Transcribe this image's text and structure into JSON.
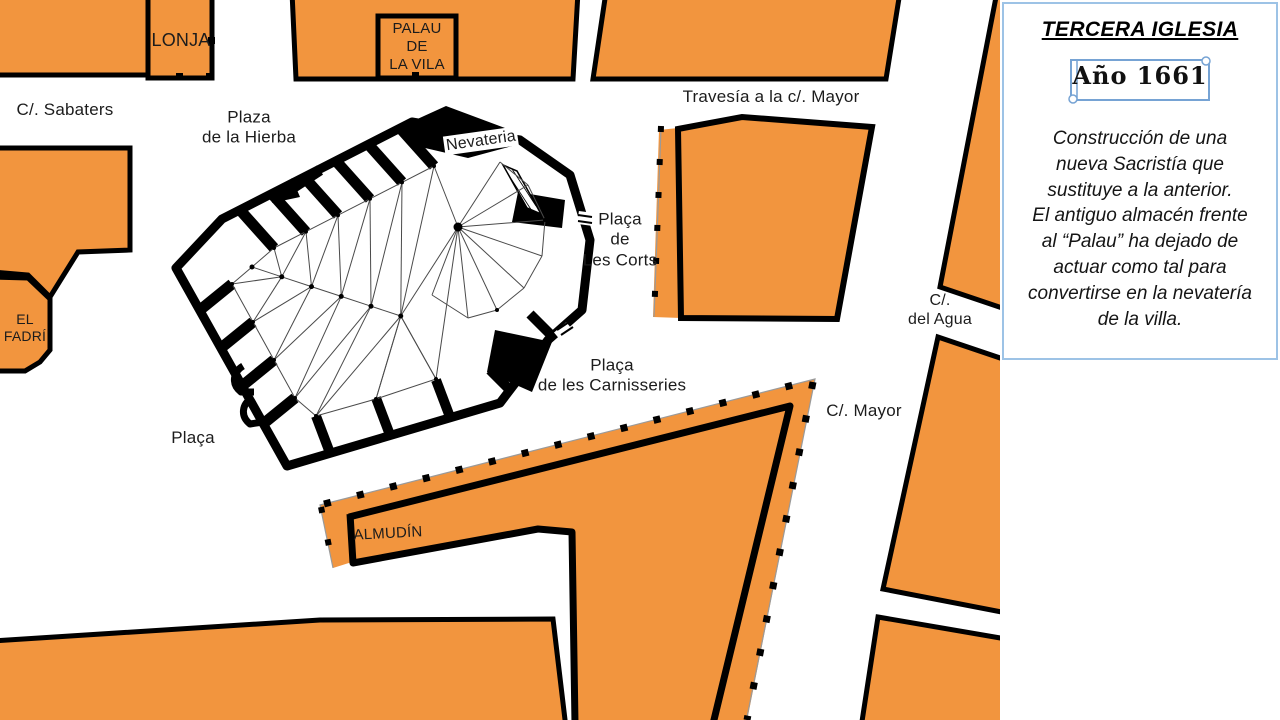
{
  "colors": {
    "building_orange": "#F2953E",
    "outline_black": "#000000",
    "panel_border_blue": "#9DC3E6",
    "scroll_border_blue": "#76A3D4"
  },
  "panel": {
    "title": "TERCERA IGLESIA",
    "year_label": "Año 1661",
    "description_lines": [
      "Construcción de una",
      "nueva Sacristía que",
      "sustituye a la anterior.",
      "El antiguo almacén frente",
      "al “Palau” ha dejado de",
      "actuar como tal para",
      "convertirse en la nevatería",
      "de la villa."
    ]
  },
  "map": {
    "labels": [
      {
        "id": "sabaters",
        "text": "C/. Sabaters",
        "x": 65,
        "y": 110,
        "size": 17,
        "rot": 0
      },
      {
        "id": "lonja",
        "text": "LONJA",
        "x": 181,
        "y": 41,
        "size": 18,
        "rot": 0
      },
      {
        "id": "palau",
        "text": "PALAU\nDE\nLA VILA",
        "x": 417,
        "y": 47,
        "size": 15,
        "rot": 0
      },
      {
        "id": "hierba",
        "text": "Plaza\nde la Hierba",
        "x": 249,
        "y": 128,
        "size": 17,
        "rot": 0
      },
      {
        "id": "nevateria",
        "text": "Nevateria",
        "x": 481,
        "y": 141,
        "size": 16,
        "rot": -8,
        "bg": "#ffffff"
      },
      {
        "id": "travesia",
        "text": "Travesía a la c/. Mayor",
        "x": 771,
        "y": 97,
        "size": 17,
        "rot": 0
      },
      {
        "id": "lescorts",
        "text": "Plaça\nde\nLes Corts",
        "x": 620,
        "y": 240,
        "size": 17,
        "rot": 0
      },
      {
        "id": "agua",
        "text": "C/.\ndel Agua",
        "x": 940,
        "y": 310,
        "size": 16,
        "rot": 0
      },
      {
        "id": "fadri",
        "text": "EL\nFADRÍ",
        "x": 25,
        "y": 328,
        "size": 14,
        "rot": 0
      },
      {
        "id": "carnisseries",
        "text": "Plaça\nde les Carnisseries",
        "x": 612,
        "y": 376,
        "size": 17,
        "rot": 0
      },
      {
        "id": "mayor",
        "text": "C/. Mayor",
        "x": 864,
        "y": 411,
        "size": 17,
        "rot": 0
      },
      {
        "id": "placa",
        "text": "Plaça",
        "x": 193,
        "y": 438,
        "size": 17,
        "rot": 0
      },
      {
        "id": "almudin",
        "text": "ALMUDÍN",
        "x": 388,
        "y": 534,
        "size": 15,
        "rot": -3
      }
    ]
  }
}
